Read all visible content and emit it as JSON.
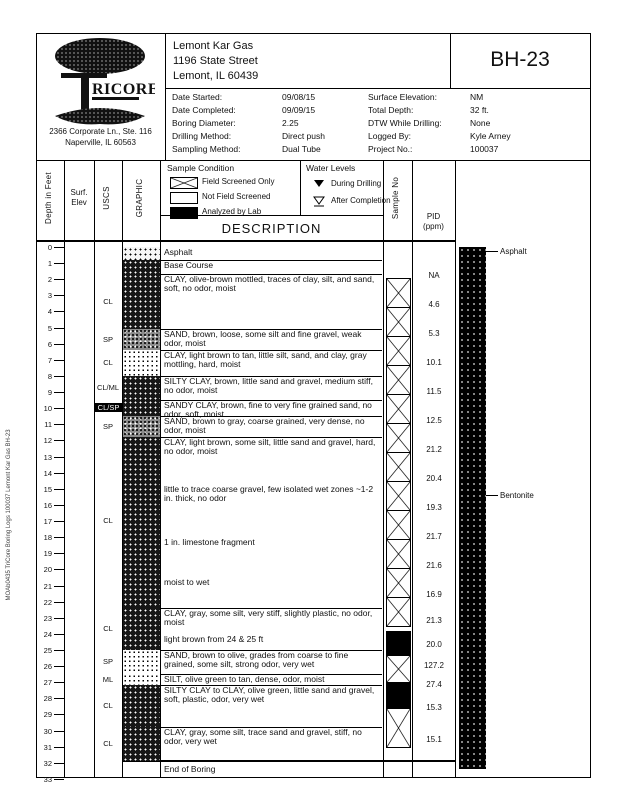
{
  "side_text": "MOAb0435   TriCore Boring Logs 100037   Lemont Kar Gas   BH-23",
  "header": {
    "boring_id": "BH-23",
    "client_lines": [
      "Lemont Kar Gas",
      "1196 State Street",
      "Lemont, IL 60439"
    ],
    "logo": {
      "big_letter": "T",
      "rest": "RICORE",
      "address1": "2366 Corporate Ln., Ste. 116",
      "address2": "Naperville, IL 60563"
    },
    "info_left": [
      {
        "label": "Date Started:",
        "value": "09/08/15"
      },
      {
        "label": "Date Completed:",
        "value": "09/09/15"
      },
      {
        "label": "Boring Diameter:",
        "value": "2.25"
      },
      {
        "label": "Drilling Method:",
        "value": "Direct push"
      },
      {
        "label": "Sampling Method:",
        "value": "Dual Tube"
      }
    ],
    "info_right": [
      {
        "label": "Surface Elevation:",
        "value": "NM"
      },
      {
        "label": "Total Depth:",
        "value": "32 ft."
      },
      {
        "label": "DTW While Drilling:",
        "value": "None"
      },
      {
        "label": "Logged By:",
        "value": "Kyle Arney"
      },
      {
        "label": "Project No.:",
        "value": "100037"
      }
    ]
  },
  "legend": {
    "sample_condition_title": "Sample Condition",
    "sample_items": [
      {
        "swatch": "x",
        "label": "Field Screened Only"
      },
      {
        "swatch": "empty",
        "label": "Not Field Screened"
      },
      {
        "swatch": "solid",
        "label": "Analyzed by Lab"
      }
    ],
    "water_title": "Water Levels",
    "water_items": [
      {
        "symbol": "filled",
        "label": "During Drilling"
      },
      {
        "symbol": "open",
        "label": "After Completion"
      }
    ]
  },
  "columns": {
    "depth": "Depth in Feet",
    "surf_line1": "Surf.",
    "surf_line2": "Elev",
    "uscs": "USCS",
    "graphic": "GRAPHIC",
    "description": "DESCRIPTION",
    "sample": "Sample No",
    "pid_line1": "PID",
    "pid_line2": "(ppm)"
  },
  "log": {
    "depth_max": 33,
    "end_label": "End of Boring",
    "layers": [
      {
        "top": 0,
        "bottom": 0.8,
        "pattern": "asphalt",
        "desc": "Asphalt"
      },
      {
        "top": 0.8,
        "bottom": 1.7,
        "pattern": "dark",
        "desc": "Base Course"
      },
      {
        "top": 1.7,
        "bottom": 5.1,
        "pattern": "dark",
        "desc": "CLAY, olive-brown mottled, traces of clay, silt, and sand, soft, no odor, moist"
      },
      {
        "top": 5.1,
        "bottom": 6.4,
        "pattern": "medium",
        "desc": "SAND, brown, loose, some silt and fine gravel, weak odor, moist"
      },
      {
        "top": 6.4,
        "bottom": 8.0,
        "pattern": "light",
        "desc": "CLAY, light brown to tan, little silt, sand, and clay, gray mottling, hard, moist"
      },
      {
        "top": 8.0,
        "bottom": 9.5,
        "pattern": "dark",
        "desc": "SILTY CLAY, brown, little sand and gravel, medium stiff, no odor, moist"
      },
      {
        "top": 9.5,
        "bottom": 10.5,
        "pattern": "dark",
        "desc": "SANDY CLAY, brown, fine to very fine grained sand, no odor, soft, moist"
      },
      {
        "top": 10.5,
        "bottom": 11.8,
        "pattern": "medium",
        "desc": "SAND, brown to gray, coarse grained, very dense, no odor, moist"
      },
      {
        "top": 11.8,
        "bottom": 22.4,
        "pattern": "dark",
        "desc": "CLAY, light brown, some silt, little sand and gravel, hard, no odor, moist"
      },
      {
        "top": 22.4,
        "bottom": 25.0,
        "pattern": "dark",
        "desc": "CLAY, gray, some silt, very stiff, slightly plastic, no odor, moist"
      },
      {
        "top": 25.0,
        "bottom": 26.5,
        "pattern": "light",
        "desc": "SAND, brown to olive, grades from coarse to fine grained, some silt, strong odor, very wet"
      },
      {
        "top": 26.5,
        "bottom": 27.2,
        "pattern": "light",
        "desc": "SILT, olive green to tan, dense, odor, moist"
      },
      {
        "top": 27.2,
        "bottom": 29.8,
        "pattern": "dark",
        "desc": "SILTY CLAY to CLAY, olive green, little sand and gravel, soft, plastic, odor, very wet"
      },
      {
        "top": 29.8,
        "bottom": 31.9,
        "pattern": "dark",
        "desc": "CLAY, gray, some silt, trace sand and gravel, stiff, no odor, very wet"
      }
    ],
    "annotations": [
      {
        "depth": 15.0,
        "text": "little to trace coarse gravel, few isolated wet zones ~1-2 in. thick, no odor"
      },
      {
        "depth": 18.3,
        "text": "1 in. limestone fragment"
      },
      {
        "depth": 20.8,
        "text": "moist to wet"
      },
      {
        "depth": 24.3,
        "text": "light brown from 24 & 25 ft"
      }
    ],
    "uscs_labels": [
      {
        "depth": 3.4,
        "text": "CL"
      },
      {
        "depth": 5.75,
        "text": "SP"
      },
      {
        "depth": 7.2,
        "text": "CL"
      },
      {
        "depth": 8.75,
        "text": "CL/ML"
      },
      {
        "depth": 10.0,
        "text": "CL/SP",
        "inverted": true
      },
      {
        "depth": 11.15,
        "text": "SP"
      },
      {
        "depth": 17.0,
        "text": "CL"
      },
      {
        "depth": 23.7,
        "text": "CL"
      },
      {
        "depth": 25.75,
        "text": "SP"
      },
      {
        "depth": 26.85,
        "text": "ML"
      },
      {
        "depth": 28.5,
        "text": "CL"
      },
      {
        "depth": 30.85,
        "text": "CL"
      }
    ],
    "samples": [
      {
        "top": 1.9,
        "bottom": 3.7,
        "type": "x"
      },
      {
        "top": 3.7,
        "bottom": 5.5,
        "type": "x"
      },
      {
        "top": 5.5,
        "bottom": 7.3,
        "type": "x"
      },
      {
        "top": 7.3,
        "bottom": 9.1,
        "type": "x"
      },
      {
        "top": 9.1,
        "bottom": 10.9,
        "type": "x"
      },
      {
        "top": 10.9,
        "bottom": 12.7,
        "type": "x"
      },
      {
        "top": 12.7,
        "bottom": 14.5,
        "type": "x"
      },
      {
        "top": 14.5,
        "bottom": 16.3,
        "type": "x"
      },
      {
        "top": 16.3,
        "bottom": 18.1,
        "type": "x"
      },
      {
        "top": 18.1,
        "bottom": 19.9,
        "type": "x"
      },
      {
        "top": 19.9,
        "bottom": 21.7,
        "type": "x"
      },
      {
        "top": 21.7,
        "bottom": 23.5,
        "type": "x"
      },
      {
        "top": 23.8,
        "bottom": 25.3,
        "type": "lab"
      },
      {
        "top": 25.3,
        "bottom": 27.0,
        "type": "x"
      },
      {
        "top": 27.0,
        "bottom": 28.6,
        "type": "lab"
      },
      {
        "top": 28.6,
        "bottom": 31.0,
        "type": "x"
      }
    ],
    "pid_values": [
      {
        "depth": 1.8,
        "value": "NA"
      },
      {
        "depth": 3.6,
        "value": "4.6"
      },
      {
        "depth": 5.4,
        "value": "5.3"
      },
      {
        "depth": 7.2,
        "value": "10.1"
      },
      {
        "depth": 9.0,
        "value": "11.5"
      },
      {
        "depth": 10.8,
        "value": "12.5"
      },
      {
        "depth": 12.6,
        "value": "21.2"
      },
      {
        "depth": 14.4,
        "value": "20.4"
      },
      {
        "depth": 16.2,
        "value": "19.3"
      },
      {
        "depth": 18.0,
        "value": "21.7"
      },
      {
        "depth": 19.8,
        "value": "21.6"
      },
      {
        "depth": 21.6,
        "value": "16.9"
      },
      {
        "depth": 23.2,
        "value": "21.3"
      },
      {
        "depth": 24.7,
        "value": "20.0"
      },
      {
        "depth": 26.0,
        "value": "127.2"
      },
      {
        "depth": 27.2,
        "value": "27.4"
      },
      {
        "depth": 28.6,
        "value": "15.3"
      },
      {
        "depth": 30.6,
        "value": "15.1"
      }
    ]
  },
  "well": {
    "labels": [
      {
        "depth": 0.25,
        "text": "Asphalt"
      },
      {
        "depth": 15.4,
        "text": "Bentonite"
      }
    ]
  }
}
